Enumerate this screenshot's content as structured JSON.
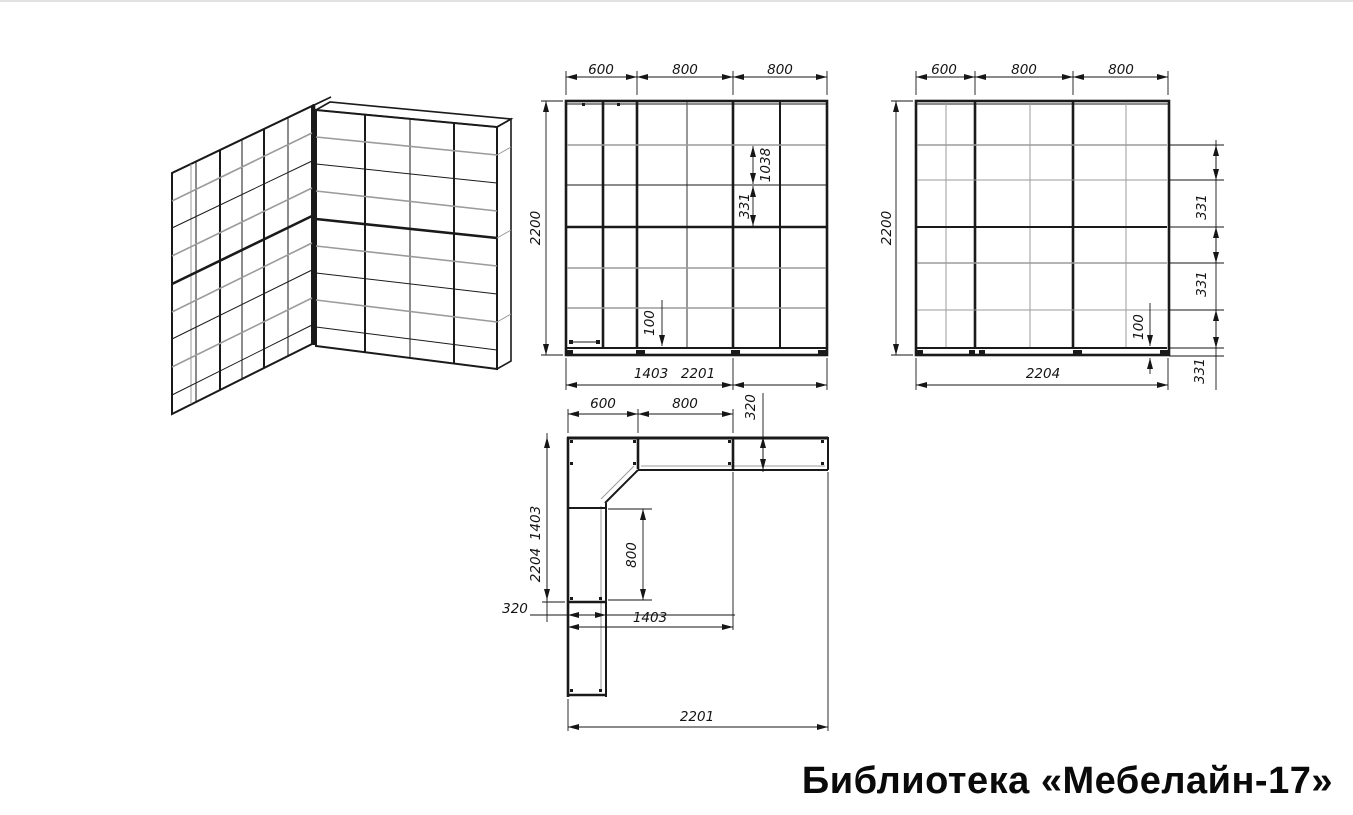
{
  "title": "Библиотека «Мебелайн-17»",
  "colors": {
    "ink": "#1a1a1a",
    "muted": "#9b9b9b"
  },
  "front_view": {
    "dim_top_1": "600",
    "dim_top_2": "800",
    "dim_top_3": "800",
    "dim_left": "2200",
    "dim_inner_height": "1038",
    "dim_inner_shelf": "331",
    "dim_plinth": "100",
    "dim_bottom_left_wing": "1403",
    "dim_bottom_total": "2201"
  },
  "back_view": {
    "dim_top_1": "600",
    "dim_top_2": "800",
    "dim_top_3": "800",
    "dim_left": "2200",
    "dim_right_shelf_1": "331",
    "dim_right_shelf_2": "331",
    "dim_right_shelf_3": "331",
    "dim_plinth": "100",
    "dim_bottom_total": "2204"
  },
  "plan_view": {
    "dim_top_1": "600",
    "dim_top_2": "800",
    "dim_depth_right": "320",
    "dim_left_wing": "1403",
    "dim_left_total": "2204",
    "dim_depth_left": "320",
    "dim_inner_width": "800",
    "dim_inner_length": "1403",
    "dim_bottom_total": "2201"
  }
}
